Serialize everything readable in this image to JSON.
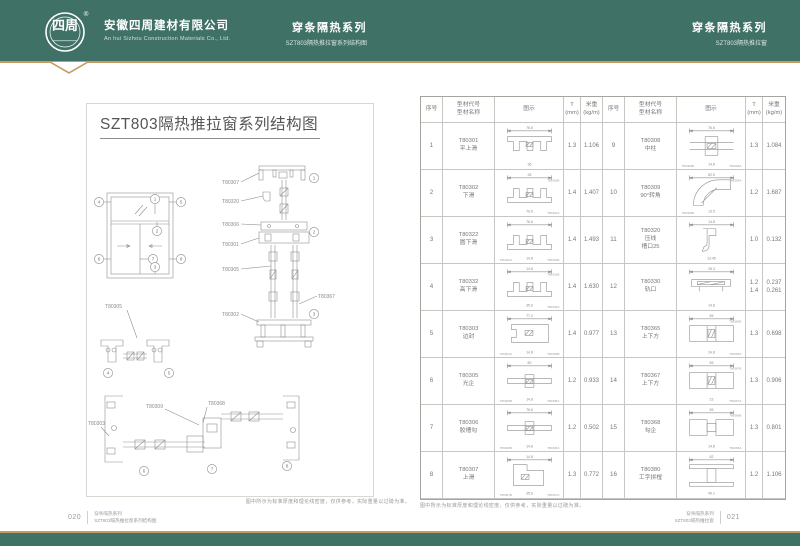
{
  "colors": {
    "header_green": "#3f7166",
    "accent_gold": "#c79a62",
    "page_background": "#ffffff"
  },
  "header": {
    "logo": {
      "text": "四周",
      "registered_mark": "®"
    },
    "company_cn": "安徽四周建材有限公司",
    "company_en": "An hui Sizhou Construction Materials Co., Ltd.",
    "center": {
      "series": "穿条隔热系列",
      "subtitle": "SZT803隔热推拉窗系列结构图"
    },
    "right": {
      "series": "穿条隔热系列",
      "subtitle": "SZT803隔热推拉窗"
    }
  },
  "left_page": {
    "title": "SZT803隔热推拉窗系列结构图",
    "note": "图中所示为标准厚度和理论线密度，仅供参考，实际重量以过磅为准。",
    "diagram": {
      "markers": [
        "1",
        "2",
        "3",
        "4",
        "5",
        "6",
        "7",
        "8"
      ],
      "vertical_section_labels": {
        "top": "T80307",
        "bead": "T80320",
        "mid1": "T80306",
        "mid2": "T80301",
        "sash": "T80305",
        "bottom": "T80302",
        "right": "T80367"
      },
      "horizontal_a_label": "T80305",
      "horizontal_b_labels": {
        "left": "T80303",
        "mid_left": "T80309",
        "mid_right": "T80368"
      }
    }
  },
  "right_page": {
    "note": "图中所示为标准厚度和理论线密度，仅供参考，实际重量以过磅为准。",
    "table": {
      "columns": [
        "序号",
        "型材代号\n型材名称",
        "图示",
        "T\n(mm)",
        "米重\n(kg/m)"
      ],
      "rows": [
        {
          "seq": "1",
          "code": "T80301",
          "name": "平上滑",
          "t": "1.3",
          "weight": "1.106",
          "dims": [
            "76.6",
            "36"
          ],
          "variants": [],
          "sketch": "top-track"
        },
        {
          "seq": "2",
          "code": "T80302",
          "name": "下滑",
          "t": "1.4",
          "weight": "1.407",
          "dims": [
            "28",
            "70.6"
          ],
          "variants": [
            {
              "pos": "tr",
              "text": "T80302B"
            },
            {
              "pos": "br",
              "text": "T80302A"
            }
          ],
          "sketch": "bottom-track"
        },
        {
          "seq": "3",
          "code": "T80322",
          "name": "圆下滑",
          "t": "1.4",
          "weight": "1.493",
          "dims": [
            "76.6",
            "14.8"
          ],
          "variants": [
            {
              "pos": "bl",
              "text": "T80322A"
            },
            {
              "pos": "br",
              "text": "T80322B"
            }
          ],
          "sketch": "bottom-track"
        },
        {
          "seq": "4",
          "code": "T80332",
          "name": "高下滑",
          "t": "1.4",
          "weight": "1.630",
          "dims": [
            "14.8",
            "35.6"
          ],
          "variants": [
            {
              "pos": "tr",
              "text": "T80332B"
            },
            {
              "pos": "br",
              "text": "T80332A"
            }
          ],
          "sketch": "bottom-track"
        },
        {
          "seq": "5",
          "code": "T80303",
          "name": "边封",
          "t": "1.4",
          "weight": "0.977",
          "dims": [
            "77.2",
            "14.8"
          ],
          "variants": [
            {
              "pos": "bl",
              "text": "T80303A"
            },
            {
              "pos": "br",
              "text": "T80303B"
            }
          ],
          "sketch": "side-seal"
        },
        {
          "seq": "6",
          "code": "T80305",
          "name": "光企",
          "t": "1.2",
          "weight": "0.933",
          "dims": [
            "80",
            "14.8"
          ],
          "variants": [
            {
              "pos": "bl",
              "text": "T80305B"
            },
            {
              "pos": "br",
              "text": "T80305A"
            }
          ],
          "sketch": "stile"
        },
        {
          "seq": "7",
          "code": "T80306",
          "name": "胶槽勾",
          "t": "1.2",
          "weight": "0.502",
          "dims": [
            "76.6",
            "14.8"
          ],
          "variants": [
            {
              "pos": "bl",
              "text": "T80306B"
            },
            {
              "pos": "br",
              "text": "T80306A"
            }
          ],
          "sketch": "stile"
        },
        {
          "seq": "8",
          "code": "T80307",
          "name": "上滑",
          "t": "1.3",
          "weight": "0.772",
          "dims": [
            "14.8",
            "35.6"
          ],
          "variants": [
            {
              "pos": "bl",
              "text": "T80307B"
            },
            {
              "pos": "br",
              "text": "T80307A"
            }
          ],
          "sketch": "angle"
        },
        {
          "seq": "9",
          "code": "T80308",
          "name": "中柱",
          "t": "1.3",
          "weight": "1.084",
          "dims": [
            "76.6",
            "14.8"
          ],
          "variants": [
            {
              "pos": "bl",
              "text": "T80308B"
            },
            {
              "pos": "br",
              "text": "T80308A"
            }
          ],
          "sketch": "mullion"
        },
        {
          "seq": "10",
          "code": "T80309",
          "name": "90°转角",
          "t": "1.2",
          "weight": "1.687",
          "dims": [
            "82.5",
            "13.5"
          ],
          "variants": [
            {
              "pos": "tr",
              "text": "T80309A"
            },
            {
              "pos": "bl",
              "text": "T80309B"
            }
          ],
          "sketch": "corner"
        },
        {
          "seq": "11",
          "code": "T80320",
          "name": "压线\n槽口25",
          "t": "1.0",
          "weight": "0.132",
          "dims": [
            "14.8",
            "13.45"
          ],
          "variants": [],
          "sketch": "bead"
        },
        {
          "seq": "12",
          "code": "T80330",
          "name": "轨口",
          "t": "1.2\n1.4",
          "weight": "0.237\n0.261",
          "dims": [
            "28.3",
            "14.8"
          ],
          "variants": [],
          "sketch": "clip"
        },
        {
          "seq": "13",
          "code": "T80365",
          "name": "上下方",
          "t": "1.3",
          "weight": "0.698",
          "dims": [
            "65",
            "24.8"
          ],
          "variants": [
            {
              "pos": "tr",
              "text": "T80365B"
            },
            {
              "pos": "br",
              "text": "T80365A"
            }
          ],
          "sketch": "rail"
        },
        {
          "seq": "14",
          "code": "T80367",
          "name": "上下方",
          "t": "1.3",
          "weight": "0.906",
          "dims": [
            "65",
            "22"
          ],
          "variants": [
            {
              "pos": "tr",
              "text": "T80367B"
            },
            {
              "pos": "br",
              "text": "T80367A"
            }
          ],
          "sketch": "rail"
        },
        {
          "seq": "15",
          "code": "T80368",
          "name": "勾企",
          "t": "1.3",
          "weight": "0.801",
          "dims": [
            "55",
            "14.8"
          ],
          "variants": [
            {
              "pos": "tr",
              "text": "T80368B"
            },
            {
              "pos": "br",
              "text": "T80368A"
            }
          ],
          "sketch": "hook-stile"
        },
        {
          "seq": "16",
          "code": "T80380",
          "name": "工字拼樘",
          "t": "1.2",
          "weight": "1.106",
          "dims": [
            "82",
            "45.1"
          ],
          "variants": [],
          "sketch": "coupler"
        }
      ]
    }
  },
  "footer": {
    "left": {
      "page_no": "020",
      "line1": "穿条隔热系列",
      "line2": "SZT803隔热推拉窗系列结构图"
    },
    "right": {
      "page_no": "021",
      "line1": "穿条隔热系列",
      "line2": "SZT803隔热推拉窗"
    }
  }
}
